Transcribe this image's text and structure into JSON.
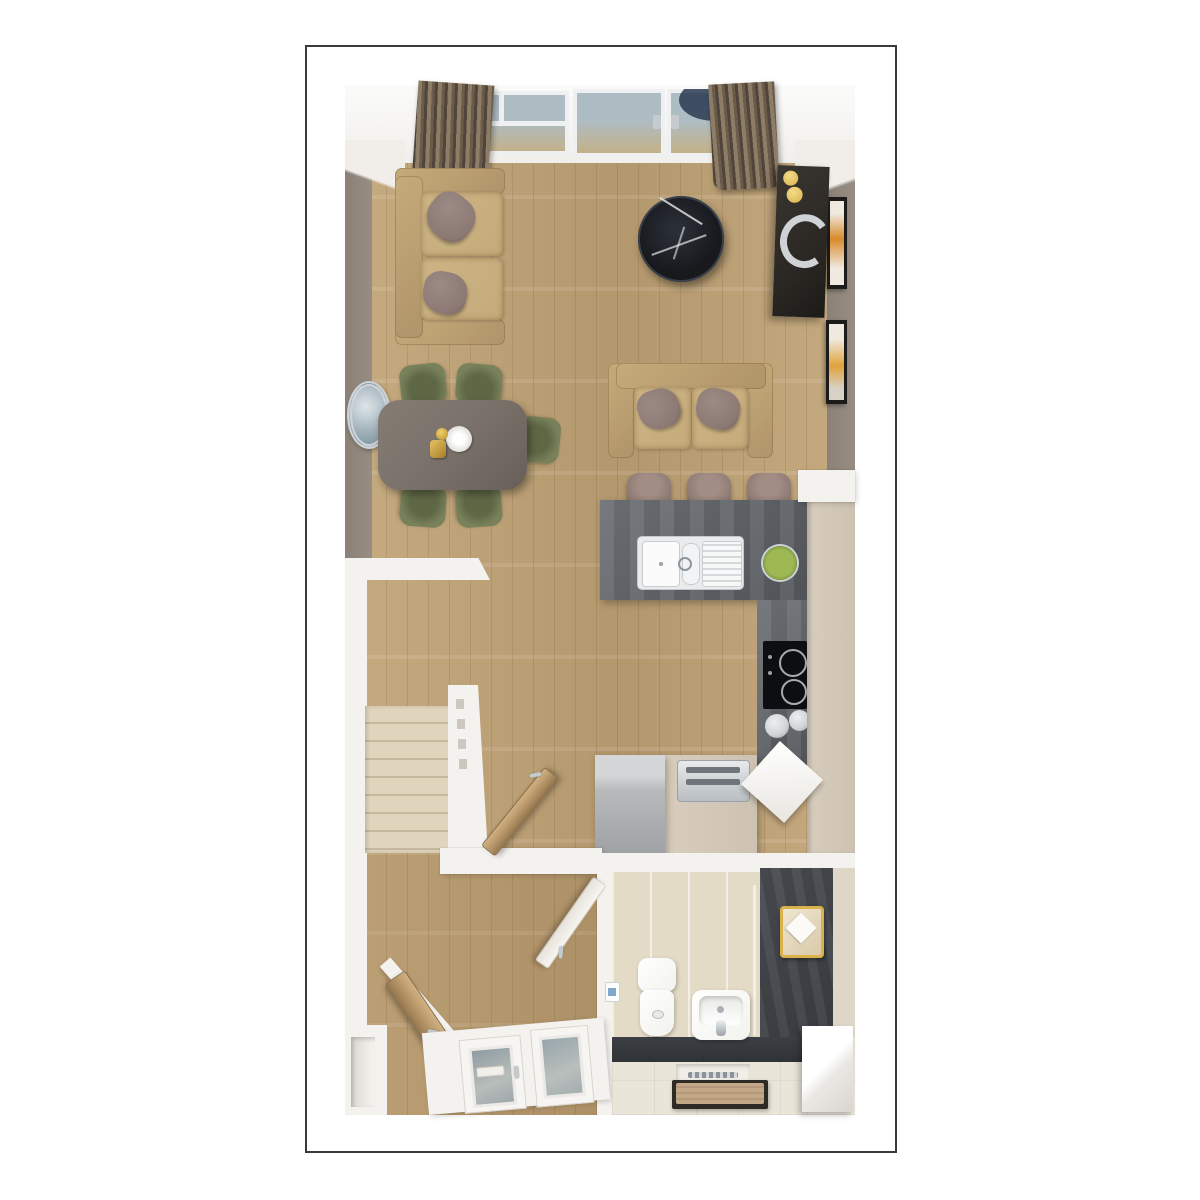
{
  "scene": {
    "type": "floor-plan-render-top-down",
    "rooms": [
      "living-dining-room",
      "kitchen",
      "stair-hall",
      "entrance-hallway",
      "bathroom"
    ],
    "objects": [
      "window-wall",
      "curtains",
      "two-seat-sofa-left",
      "two-seat-sofa-top",
      "round-coffee-table",
      "media-unit",
      "candles",
      "decor-arc",
      "wall-art",
      "wall-mirror",
      "dining-table",
      "dining-chairs",
      "table-decor",
      "kitchen-peninsula",
      "double-sink",
      "fruit-bowl",
      "bar-stools",
      "hob",
      "pans",
      "tall-cabinets",
      "base-cabinet",
      "toaster",
      "under-counter-appliance",
      "cutting-board",
      "carpeted-staircase",
      "banister",
      "living-room-door",
      "bathroom-door",
      "understairs-door",
      "front-door-with-glazing",
      "toilet",
      "basin",
      "toilet-roll-holder",
      "towel-shelf",
      "shower-screen",
      "shower-drain",
      "bath-mat",
      "storage-bench"
    ]
  },
  "palette": {
    "paper": "#ffffff",
    "frame-border": "#3a3a3a",
    "wood-floor": "#c6ab80",
    "wood-dark": "#b3976d",
    "wall-taupe": "#8b8177",
    "wall-white": "#f4f2ee",
    "sofa": "#c5ab7a",
    "sofa-dark": "#b0946a",
    "pillow": "#8c7974",
    "table-top": "#7a716a",
    "chair": "#79815b",
    "chair-dark": "#5e6845",
    "coffee-table": "#17191d",
    "marble-vein": "#e8eaec",
    "tv-unit": "#2b2824",
    "gold": "#d9b24a",
    "counter-slate": "#6f7377",
    "counter-slate-dark": "#55585c",
    "cabinet-cream": "#d8cdbd",
    "appliance-gray": "#b7b9bb",
    "stool": "#8d7a73",
    "apples": "#9eb954",
    "hob-black": "#0d0e11",
    "steel": "#cfd3d6",
    "stair-carpet": "#e0d5bc",
    "stair-edge": "#c4b89e",
    "curtain-light": "#8d7c66",
    "curtain-dark": "#50453a",
    "glass": "#aebcc4",
    "glass-warm": "#c3b189",
    "navy": "#2c3a52",
    "door-wood": "#bd9d6e",
    "door-wood-dark": "#97784f",
    "bath-tile-wall": "#e4dbc7",
    "bath-tile-floor": "#eae5d9",
    "bath-slate": "#4a4e53",
    "bath-slate-dark": "#3c4044",
    "porcelain": "#f2f2ee",
    "chrome": "#c6cbd0",
    "mat-tray": "#2e2a26",
    "mat-towel": "#c3a887"
  }
}
